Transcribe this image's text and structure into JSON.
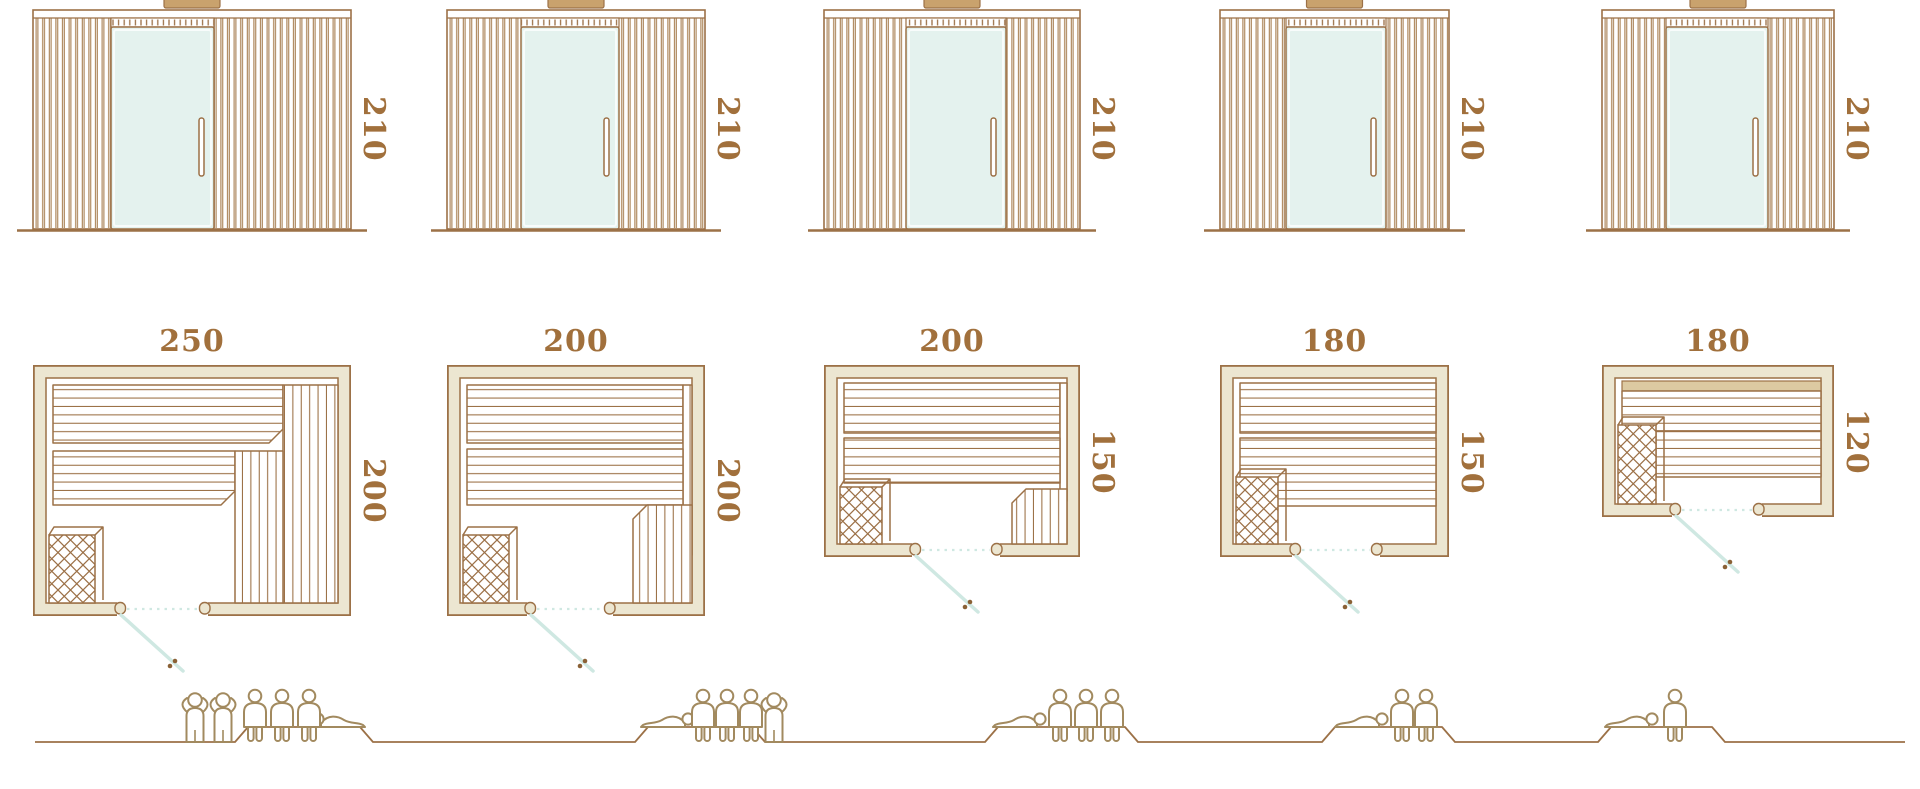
{
  "diagram": {
    "description": "Sauna cabin size range: front elevations, floor plans and capacity figures",
    "units": "cm",
    "colors": {
      "outline": "#9c7147",
      "wall_fill": "#ece6d1",
      "roof_cap": "#c9a26d",
      "glass": "#e4f2ee",
      "door_swing": "#cfe8e2",
      "label_text": "#a1703c",
      "figure_outline": "#a28a5f",
      "handle_dots": "#8a6136"
    }
  },
  "models": [
    {
      "elevation_height": "210",
      "plan_width": "250",
      "plan_depth": "200",
      "capacity": {
        "standing": 2,
        "sitting": 3,
        "lying": 1,
        "total": 6
      }
    },
    {
      "elevation_height": "210",
      "plan_width": "200",
      "plan_depth": "200",
      "capacity": {
        "standing": 1,
        "sitting": 3,
        "lying": 1,
        "total": 5
      }
    },
    {
      "elevation_height": "210",
      "plan_width": "200",
      "plan_depth": "150",
      "capacity": {
        "standing": 0,
        "sitting": 3,
        "lying": 1,
        "total": 4
      }
    },
    {
      "elevation_height": "210",
      "plan_width": "180",
      "plan_depth": "150",
      "capacity": {
        "standing": 0,
        "sitting": 2,
        "lying": 1,
        "total": 3
      }
    },
    {
      "elevation_height": "210",
      "plan_width": "180",
      "plan_depth": "120",
      "capacity": {
        "standing": 0,
        "sitting": 1,
        "lying": 1,
        "total": 2
      }
    }
  ]
}
